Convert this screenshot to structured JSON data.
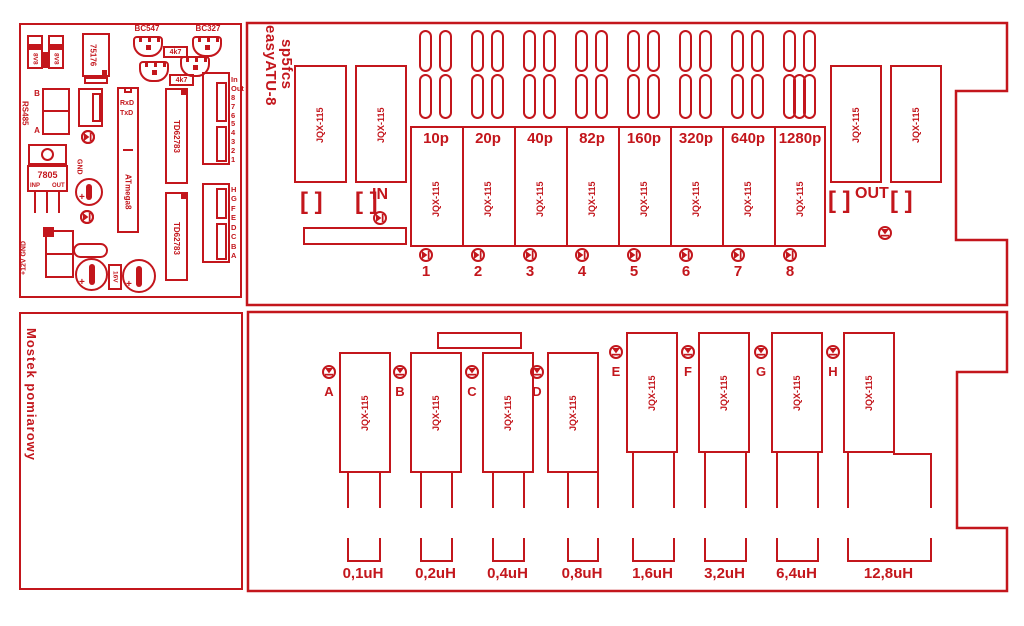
{
  "colors": {
    "red": "#c3161c"
  },
  "top_board": {
    "title_line1": "easyATU-8",
    "title_line2": "sp5fcs",
    "relay_label": "JQX-115",
    "in_label": "IN",
    "out_label": "OUT",
    "bracket": "[ ]",
    "capacitor_sections": [
      {
        "value": "10p",
        "num": "1"
      },
      {
        "value": "20p",
        "num": "2"
      },
      {
        "value": "40p",
        "num": "3"
      },
      {
        "value": "82p",
        "num": "4"
      },
      {
        "value": "160p",
        "num": "5"
      },
      {
        "value": "320p",
        "num": "6"
      },
      {
        "value": "640p",
        "num": "7"
      },
      {
        "value": "1280p",
        "num": "8"
      }
    ]
  },
  "control_board": {
    "zener_label": "8V8",
    "transceiver": "75176",
    "transistor1": "BC547",
    "transistor2": "BC327",
    "resistor1": "4k7",
    "resistor2": "4k7",
    "rs485": "RS485",
    "rs485_b": "B",
    "rs485_a": "A",
    "regulator": "7805",
    "regulator_in": "INP",
    "regulator_out": "OUT",
    "gnd": "GND",
    "power": "+12V GND",
    "cap_voltage": "16V",
    "mcu": "ATmega8",
    "mcu_rxd": "RxD",
    "mcu_txd": "TxD",
    "driver1": "TD62783",
    "driver2": "TD62783",
    "header_top_labels": [
      "In",
      "Out",
      "8",
      "7",
      "6",
      "5",
      "4",
      "3",
      "2",
      "1"
    ],
    "header_bottom_labels": [
      "H",
      "G",
      "F",
      "E",
      "D",
      "C",
      "B",
      "A"
    ]
  },
  "bottom_board": {
    "title": "Mostek pomiarowy",
    "relay_label": "JQX-115",
    "inductors": [
      {
        "letter": "A",
        "value": "0,1uH"
      },
      {
        "letter": "B",
        "value": "0,2uH"
      },
      {
        "letter": "C",
        "value": "0,4uH"
      },
      {
        "letter": "D",
        "value": "0,8uH"
      },
      {
        "letter": "E",
        "value": "1,6uH"
      },
      {
        "letter": "F",
        "value": "3,2uH"
      },
      {
        "letter": "G",
        "value": "6,4uH"
      },
      {
        "letter": "H",
        "value": "12,8uH"
      }
    ]
  }
}
